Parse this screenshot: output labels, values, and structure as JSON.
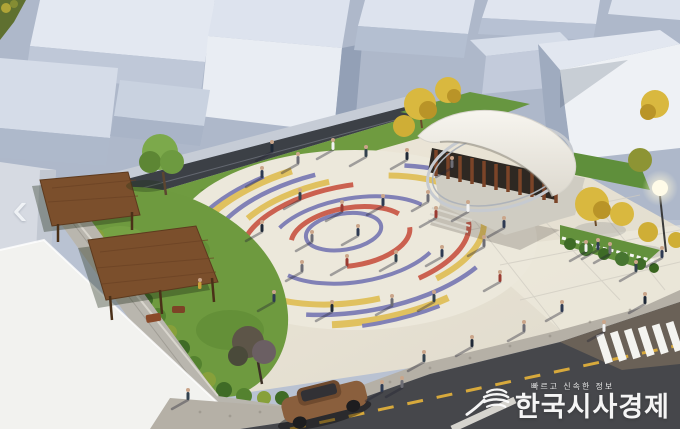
{
  "watermark": {
    "tagline": "빠르고 신속한 정보",
    "title": "한국시사경제"
  },
  "carousel": {
    "prev_glyph": "‹"
  },
  "palette": {
    "ring_blue": "#6f70b0",
    "ring_red": "#c64a38",
    "ring_yellow": "#dfbb4a",
    "plaza_pavement": "#e9e4d6",
    "grass": "#6e9a3f",
    "pergola_wood": "#7b4f2c",
    "asphalt": "#46474b",
    "building_face": "#eef1f5",
    "building_side": "#9fabbf",
    "canopy_white": "#f2f0ea",
    "car_brown": "#8a5f3d",
    "foliage_yellow": "#d9b83f",
    "watermark_text": "#ffffff"
  }
}
